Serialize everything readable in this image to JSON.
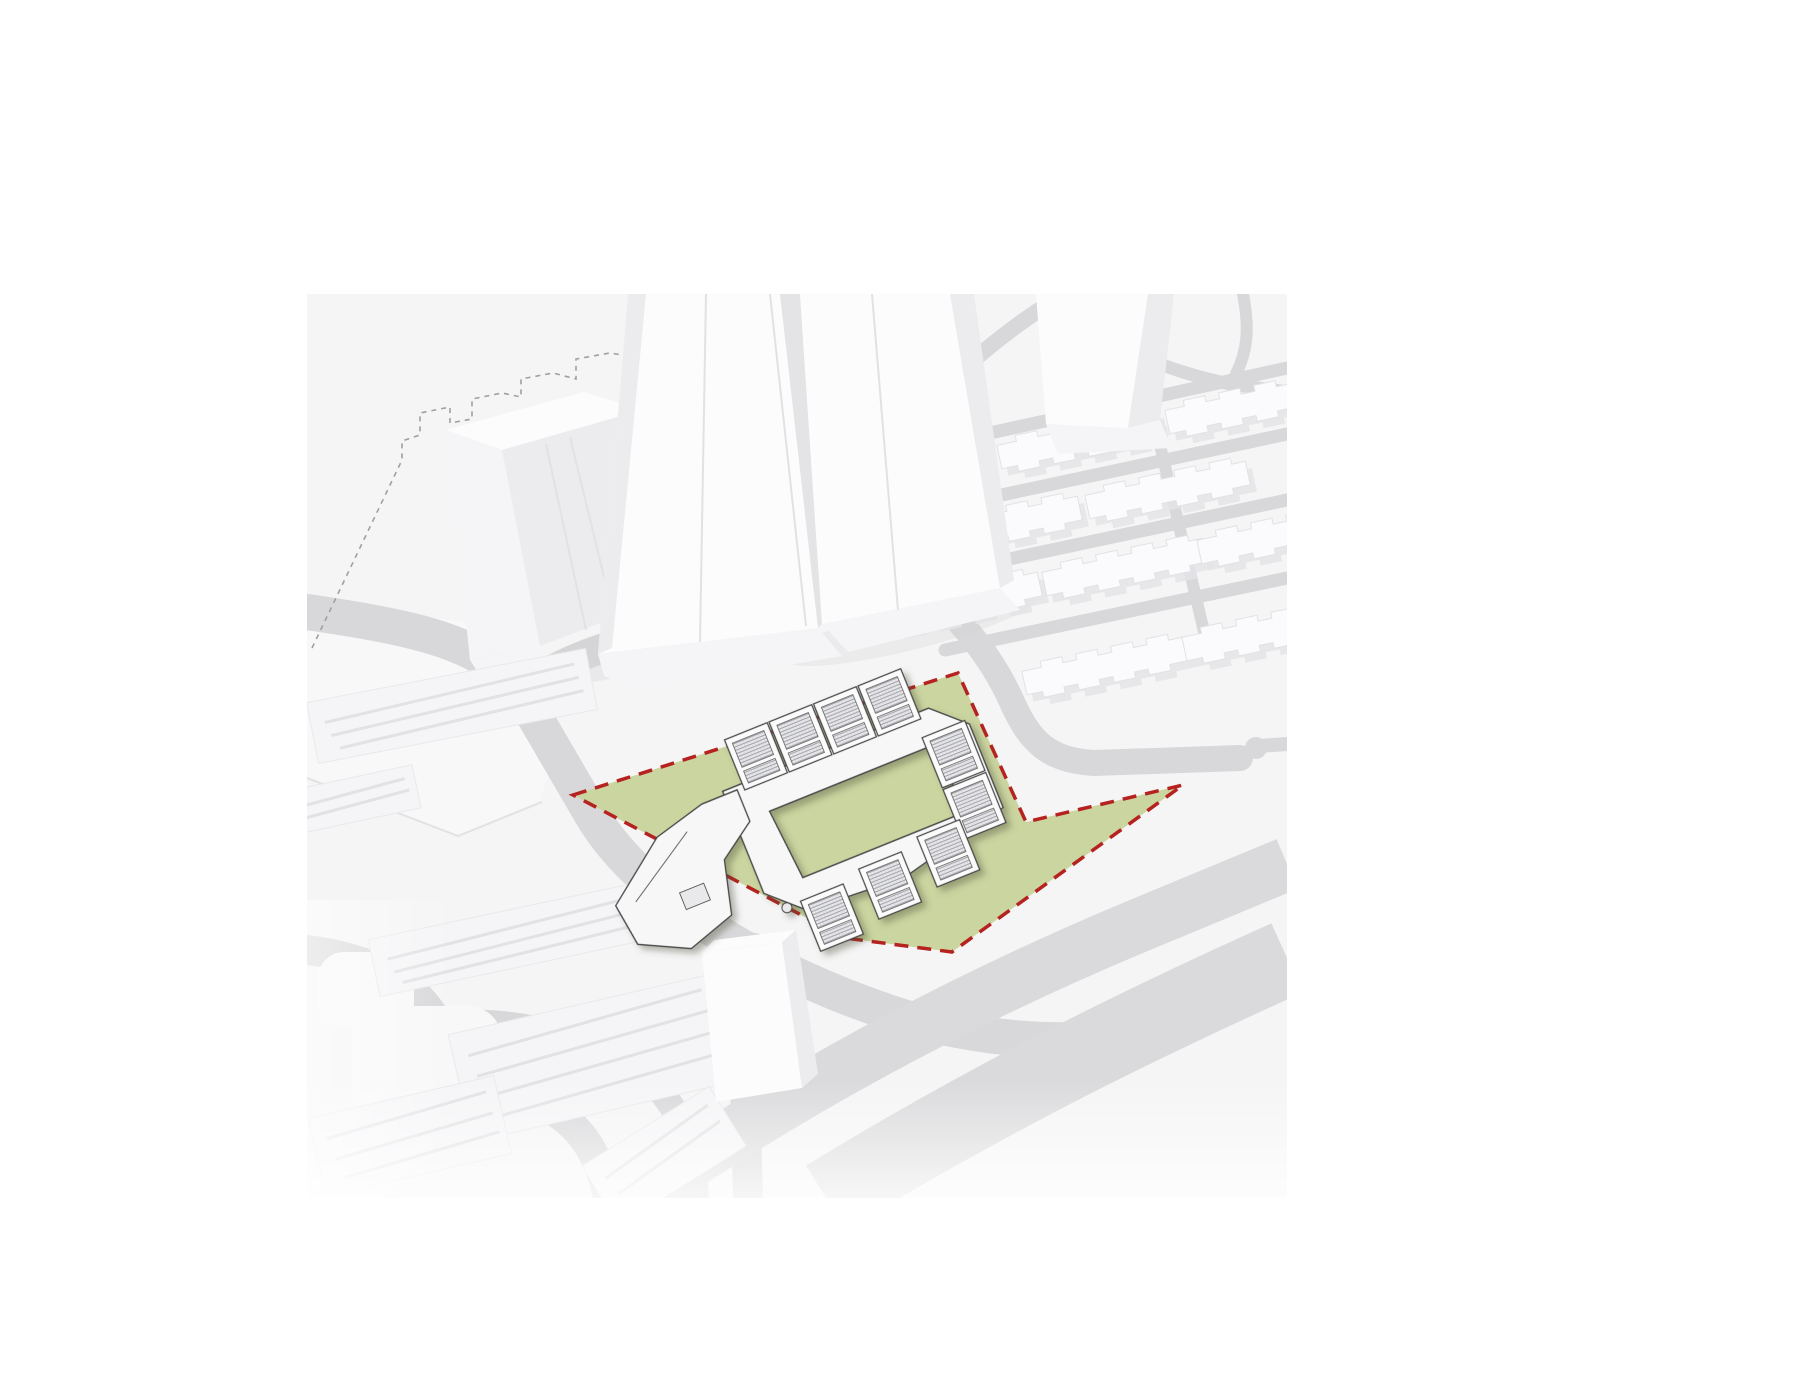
{
  "canvas": {
    "bg": "#ffffff",
    "width": 1800,
    "height": 1400
  },
  "scene": {
    "x": 307,
    "y": 294,
    "w": 980,
    "h": 904,
    "bg": "#f5f5f6"
  },
  "palette": {
    "road": "#d8d8da",
    "highway": "#dadadc",
    "island": "#f8f8f9",
    "plateau": "#f8f8f9",
    "building_top": "#fcfcfd",
    "building_front": "#f5f5f7",
    "building_side": "#ececef",
    "slab_body": "#fbfbfd",
    "slab_shadow": "#e4e4e7",
    "edge": "#e2e2e5",
    "site_green": "#cbd5a0",
    "boundary_red": "#b5221f",
    "outline_dash": "#9fa0a4",
    "complex_line": "#474747",
    "complex_white": "#f7f7f8",
    "hatch_bg": "#e9e9ec",
    "hatch_line": "#90929a",
    "ground_shadow": "#d0d0d4"
  },
  "site": {
    "points": "573,795 958,673 1026,822 1183,785 952,952 845,938",
    "dash": "14 9",
    "stroke_width": 3.5
  },
  "roads": {
    "items": [
      {
        "d": "M307,612 C390,624 450,636 486,660 C508,674 518,690 532,712",
        "w": 36
      },
      {
        "d": "M532,712 L588,808 C612,852 652,888 702,922 C764,964 836,996 906,1018 C964,1034 1024,1042 1082,1040",
        "w": 36
      },
      {
        "d": "M516,700 C542,672 572,658 610,646 C712,612 806,586 902,564",
        "w": 30
      },
      {
        "d": "M902,564 C872,518 878,462 916,418 C952,376 994,340 1042,308 L1068,294",
        "w": 16
      },
      {
        "d": "M902,564 C954,612 990,652 1012,702 C1030,742 1048,760 1094,763 L1240,758",
        "w": 26
      },
      {
        "d": "M958,440 L1287,368",
        "w": 13
      },
      {
        "d": "M950,506 L1287,434",
        "w": 13
      },
      {
        "d": "M948,572 L1287,500",
        "w": 13
      },
      {
        "d": "M945,650 L1287,578",
        "w": 13
      },
      {
        "d": "M1138,352 L1206,640",
        "w": 12
      },
      {
        "d": "M1055,296 C1092,338 1152,368 1230,384 L1287,392",
        "w": 13
      },
      {
        "d": "M1243,294 C1250,330 1247,352 1236,374",
        "w": 12
      },
      {
        "d": "M754,948 C748,1002 744,1064 746,1128 L748,1198",
        "w": 30
      },
      {
        "d": "M307,950 C372,958 414,982 436,1020 C452,1048 468,1078 516,1094 C568,1110 598,1142 608,1198",
        "w": 30
      },
      {
        "d": "M440,1024 C512,1018 574,1032 632,1068 C672,1092 692,1130 696,1198",
        "w": 26
      },
      {
        "d": "M1082,1040 C1130,1034 1166,1018 1196,998",
        "w": 40
      }
    ]
  },
  "highway": {
    "bands": [
      {
        "d": "M636,1198 C790,1092 948,1006 1128,930 L1287,864",
        "w": 54
      },
      {
        "d": "M826,1198 C976,1106 1122,1032 1287,958",
        "w": 76
      }
    ]
  },
  "culdesac": {
    "stub": "M1287,744 L1258,746",
    "w": 14,
    "cx": 1256,
    "cy": 748,
    "r": 11
  },
  "islands": {
    "items": [
      {
        "x": 352,
        "y": 1006,
        "w": 150,
        "h": 140,
        "rx": 34
      },
      {
        "x": 318,
        "y": 952,
        "w": 96,
        "h": 76,
        "rx": 26
      }
    ]
  },
  "plateau": {
    "d": "M307,598 L462,622 C492,628 508,640 520,662 L560,740 L540,800 L458,836 L307,776 Z",
    "edge": "M307,778 L458,836 L542,802"
  },
  "dashed_outline": {
    "dash": "5 5",
    "paths": [
      "M312,648 L402,460 L402,441 L420,435 L420,413 L450,407 L450,423 L472,419 L472,399 L502,393 L521,397 L521,379 L553,373 L576,379 L576,359 L610,353 L634,357",
      "M671,294 L671,386 M656,392 L700,381"
    ]
  },
  "shadows": {
    "items": [
      {
        "cx": 640,
        "cy": 648,
        "rx": 120,
        "ry": 24,
        "rot": -14,
        "o": 0.32
      },
      {
        "cx": 910,
        "cy": 628,
        "rx": 130,
        "ry": 22,
        "rot": -14,
        "o": 0.28
      },
      {
        "cx": 1105,
        "cy": 442,
        "rx": 68,
        "ry": 14,
        "rot": -10,
        "o": 0.22
      }
    ]
  },
  "towers": {
    "tl_top": "446,430 584,392 642,410 502,450",
    "tl_front": "446,430 502,450 540,646 470,660",
    "tl_side": "502,450 642,410 692,588 540,646",
    "tl_seams": "M546,444 L586,630 M570,437 L614,618",
    "tl_base": "470,660 540,646 556,668 484,682",
    "t1_front": "628,294 780,294 818,628 598,654",
    "t1_strip": "628,294 646,294 612,648 598,654",
    "t1_seam": "M706,294 L700,642",
    "t1_seam2": "M770,294 L806,626",
    "gap": "780,294 800,294 822,624 818,628",
    "t2_front": "800,294 950,294 1000,588 822,624",
    "t2_strip": "950,294 974,294 1014,580 1000,588",
    "t2_seam": "M872,294 L898,610",
    "t_base1": "598,654 818,628 842,656 640,690 604,676",
    "t_base2": "822,624 1000,588 1020,610 848,652",
    "fr_front": "1036,294 1148,294 1128,428 1046,424",
    "fr_side": "1148,294 1174,294 1160,420 1128,428",
    "fr_base": "1046,424 1128,428 1160,420 1172,448 1058,454"
  },
  "grid": {
    "slabs": [
      "translate(1080,442) rotate(-12)",
      "translate(1248,407) rotate(-12)",
      "translate(1000,527) rotate(-12)",
      "translate(1168,492) rotate(-12)",
      "translate(960,603) rotate(-12)",
      "translate(1125,569) rotate(-12)",
      "translate(1280,537) rotate(-12)",
      "translate(1105,668) rotate(-12)",
      "translate(1265,634) rotate(-12)"
    ]
  },
  "west_slabs": {
    "items": [
      {
        "t": "translate(452,706) rotate(-11)",
        "x": -142,
        "y": -31,
        "w": 284,
        "h": 62,
        "ridges": "M-128,-8 L128,-18 M-124,6 L130,-4 M-118,20 L132,10"
      },
      {
        "t": "translate(516,938) rotate(-12)",
        "x": -145,
        "y": -29,
        "w": 290,
        "h": 58,
        "ridges": "M-130,-6 L130,-16 M-126,8 L132,-2 M-120,20 L134,12"
      },
      {
        "t": "translate(352,800) rotate(-12)",
        "x": -66,
        "y": -22,
        "w": 132,
        "h": 44,
        "ridges": "M-54,-4 L56,-10 M-50,8 L58,2"
      },
      {
        "t": "translate(592,1058) rotate(-13)",
        "x": -135,
        "y": -55,
        "w": 270,
        "h": 110,
        "ridges": "M-120,-30 L122,-42 M-116,-8 L124,-20 M-112,14 L126,2 M-108,36 L128,24"
      },
      {
        "t": "translate(410,1136) rotate(-13)",
        "x": -95,
        "y": -40,
        "w": 190,
        "h": 80,
        "ridges": "M-82,-16 L84,-26 M-78,6 L86,-4 M-74,26 L88,16"
      },
      {
        "t": "translate(664,1156) rotate(-32)",
        "x": -75,
        "y": -35,
        "w": 150,
        "h": 70,
        "ridges": "M-62,-12 L64,-20 M-58,8 L66,0"
      }
    ]
  },
  "bottom_tower": {
    "front": "702,952 782,942 802,1088 716,1102",
    "top": "702,952 782,942 796,930 714,940",
    "side": "782,942 796,930 818,1074 802,1088"
  },
  "complex": {
    "transform": "translate(810,810) rotate(-22)",
    "ring": "M-74,-50 L148,-50 L180,-20 L180,70 L62,98 L-40,92 L-74,60 Z M-38,-14 L142,-14 L142,60 L-32,60 Z",
    "wing": "M-216,16 L-152,-32 L-98,-46 L-60,-46 L-60,-12 L-98,14 L-112,68 L-162,84 L-210,60 Z",
    "wing_line": "M-196,20 L-122,-26",
    "wing_rect": {
      "x": -152,
      "y": 28,
      "w": 26,
      "h": 18
    },
    "dome": {
      "cx": -58,
      "cy": 82,
      "r": 5
    },
    "pavilions": [
      "translate(-30,-70)",
      "translate(18,-70)",
      "translate(66,-70)",
      "translate(114,-70)",
      "translate(154,2)",
      "translate(154,58)",
      "translate(-20,108)",
      "translate(46,100)",
      "translate(112,92)"
    ]
  },
  "fades": {
    "bottom": {
      "x": 307,
      "y": 1080,
      "w": 980,
      "h": 118
    },
    "left": {
      "x": 307,
      "y": 900,
      "w": 150,
      "h": 298
    }
  }
}
